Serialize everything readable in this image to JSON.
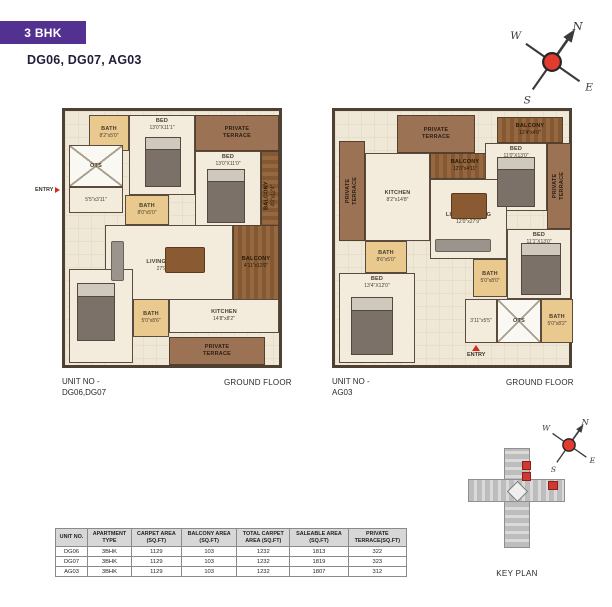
{
  "page": {
    "badge": "3 BHK",
    "subtitle": "DG06, DG07, AG03"
  },
  "compass": {
    "north": "N",
    "south": "S",
    "east": "E",
    "west": "W"
  },
  "plans": [
    {
      "unit_no_label": "UNIT NO -",
      "unit_no_value": "DG06,DG07",
      "floor_label": "GROUND FLOOR",
      "entry_label": "ENTRY",
      "rooms": [
        {
          "name": "BATH",
          "dim": "8'2\"x5'0\""
        },
        {
          "name": "BED",
          "dim": "13'0\"X11'1\""
        },
        {
          "name": "PRIVATE\nTERRACE",
          "dim": ""
        },
        {
          "name": "BED",
          "dim": "13'0\"X11'0\""
        },
        {
          "name": "BALCONY",
          "dim": "4'0\"x12'4\""
        },
        {
          "name": "OTS",
          "dim": ""
        },
        {
          "name": "",
          "dim": "5'5\"x3'11\""
        },
        {
          "name": "BATH",
          "dim": "8'0\"x5'0\""
        },
        {
          "name": "LIVING / DINING",
          "dim": "27'9\"x12'0\""
        },
        {
          "name": "BALCONY",
          "dim": "4'11\"x12'0\""
        },
        {
          "name": "KITCHEN",
          "dim": "14'8\"x8'2\""
        },
        {
          "name": "BATH",
          "dim": "5'0\"x8'6\""
        },
        {
          "name": "BED",
          "dim": "12'0\"X13'4\""
        },
        {
          "name": "PRIVATE\nTERRACE",
          "dim": ""
        }
      ]
    },
    {
      "unit_no_label": "UNIT NO -",
      "unit_no_value": "AG03",
      "floor_label": "GROUND FLOOR",
      "entry_label": "ENTRY",
      "rooms": [
        {
          "name": "PRIVATE\nTERRACE",
          "dim": ""
        },
        {
          "name": "PRIVATE\nTERRACE",
          "dim": ""
        },
        {
          "name": "KITCHEN",
          "dim": "8'2\"x14'8\""
        },
        {
          "name": "BALCONY",
          "dim": "12'0\"x4'11\""
        },
        {
          "name": "BALCONY",
          "dim": "12'4\"x4'0\""
        },
        {
          "name": "BED",
          "dim": "11'0\"X13'0\""
        },
        {
          "name": "PRIVATE\nTERRACE",
          "dim": ""
        },
        {
          "name": "BED",
          "dim": "11'1\"X13'0\""
        },
        {
          "name": "LIVING / DINING",
          "dim": "12'0\"x27'9\""
        },
        {
          "name": "BATH",
          "dim": "8'6\"x5'0\""
        },
        {
          "name": "BED",
          "dim": "13'4\"X12'0\""
        },
        {
          "name": "BATH",
          "dim": "5'0\"x8'0\""
        },
        {
          "name": "OTS",
          "dim": ""
        },
        {
          "name": "",
          "dim": "3'11\"x5'5\""
        },
        {
          "name": "BATH",
          "dim": "5'0\"x8'2\""
        }
      ]
    }
  ],
  "key_plan": {
    "label": "KEY PLAN"
  },
  "table": {
    "headers": [
      "UNIT NO.",
      "APARTMENT\nTYPE",
      "CARPET AREA\n(SQ.FT)",
      "BALCONY AREA\n(SQ.FT)",
      "TOTAL CARPET\nAREA (SQ.FT)",
      "SALEABLE AREA\n(SQ.FT)",
      "PRIVATE\nTERRACE(SQ.FT)"
    ],
    "rows": [
      [
        "DG06",
        "3BHK",
        "1129",
        "103",
        "1232",
        "1813",
        "322"
      ],
      [
        "DG07",
        "3BHK",
        "1129",
        "103",
        "1232",
        "1819",
        "323"
      ],
      [
        "AG03",
        "3BHK",
        "1129",
        "103",
        "1232",
        "1807",
        "312"
      ]
    ]
  },
  "colors": {
    "accent_purple": "#533191",
    "compass_red": "#e23b30",
    "keyplan_red": "#cf3a30"
  }
}
